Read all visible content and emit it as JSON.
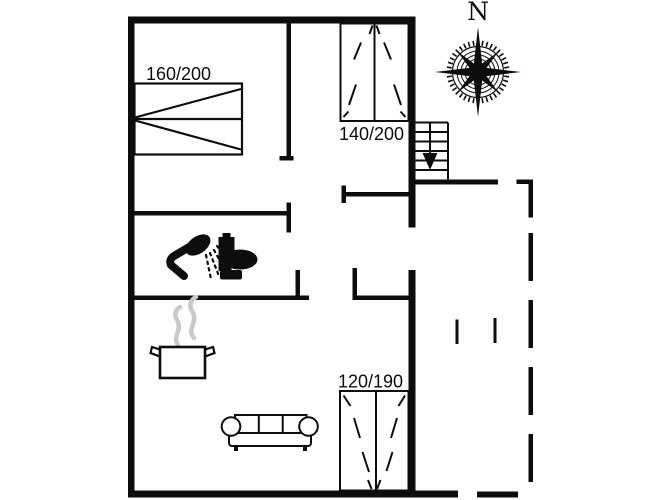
{
  "colors": {
    "ink": "#0d0d0d",
    "steam": "#c8c8c8",
    "background": "#ffffff"
  },
  "compass": {
    "north_label": "N"
  },
  "bed_labels": {
    "master_bed": "160/200",
    "upper_bed": "140/200",
    "lower_bed": "120/190"
  },
  "icons": {
    "compass": "compass-rose-icon",
    "stairs": "stairs-down-arrow-icon",
    "shower": "shower-icon",
    "toilet": "toilet-icon",
    "pot": "cooking-pot-icon",
    "steam": "steam-icon",
    "sofa": "sofa-icon",
    "master_bed": "double-bed-icon",
    "upper_bed": "bed-140x200-icon",
    "lower_bed": "bed-120x190-icon"
  }
}
